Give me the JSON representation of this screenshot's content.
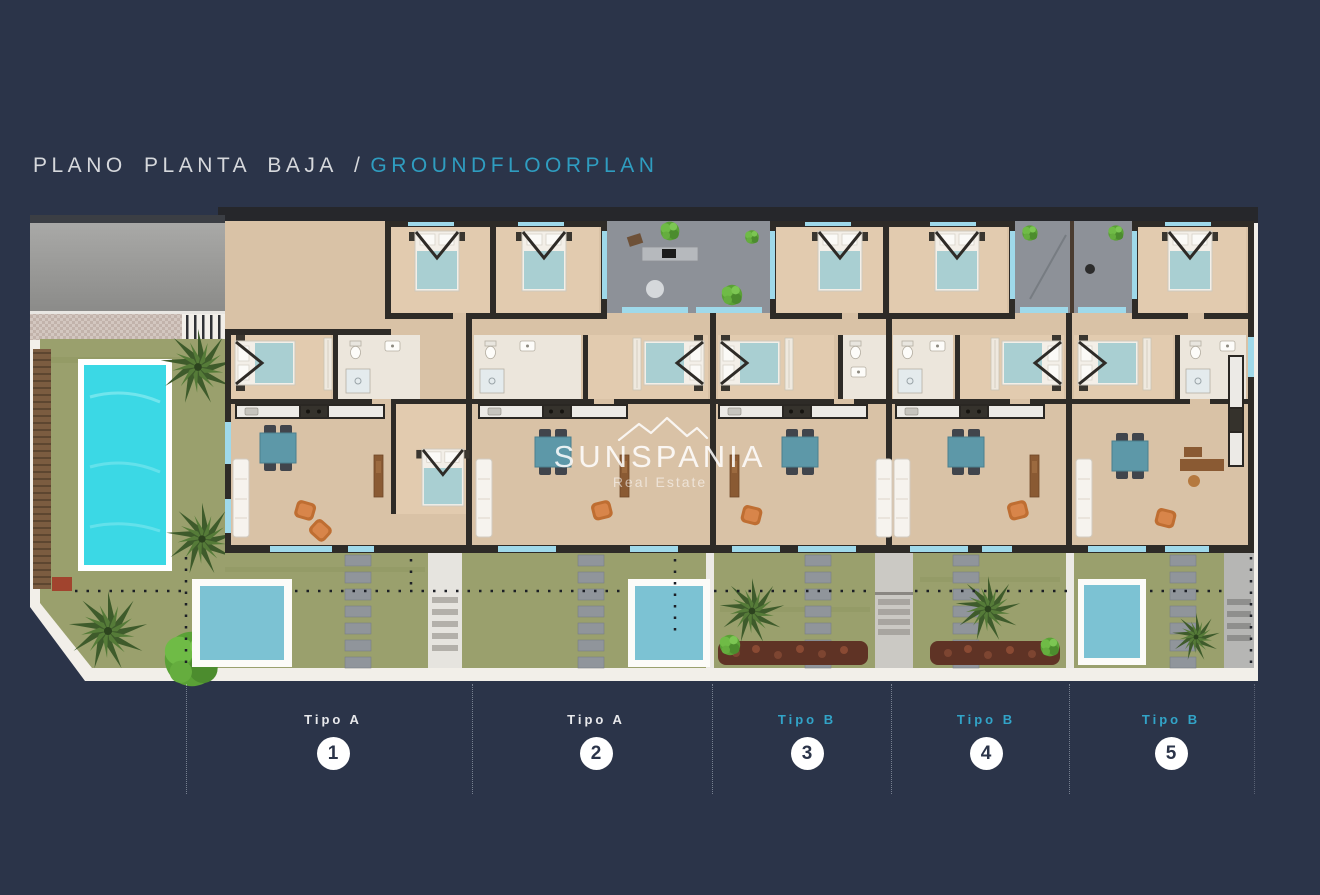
{
  "title": {
    "left": "PLANO PLANTA BAJA /",
    "right": "GROUNDFLOORPLAN"
  },
  "watermark": {
    "brand": "SUNSPANIA",
    "tagline": "Real Estate"
  },
  "units": [
    {
      "label": "Tipo A",
      "number": "1",
      "type": "A"
    },
    {
      "label": "Tipo A",
      "number": "2",
      "type": "A"
    },
    {
      "label": "Tipo B",
      "number": "3",
      "type": "B"
    },
    {
      "label": "Tipo B",
      "number": "4",
      "type": "B"
    },
    {
      "label": "Tipo B",
      "number": "5",
      "type": "B"
    }
  ],
  "colors": {
    "background": "#2b3449",
    "accent_cyan": "#2f9dc0",
    "label_light": "#e8e9ec",
    "label_cyan": "#32a4c8",
    "plan_paper": "#f2efe9",
    "wall": "#2e2b27",
    "floor_tan": "#d9c2a6",
    "lawn_green": "#9aa06d",
    "pool_cyan": "#3bd8e5",
    "plunge_pool_teal": "#7cc2d3",
    "patio_gray": "#8d9198",
    "window_cyan": "#9fd9ea"
  }
}
